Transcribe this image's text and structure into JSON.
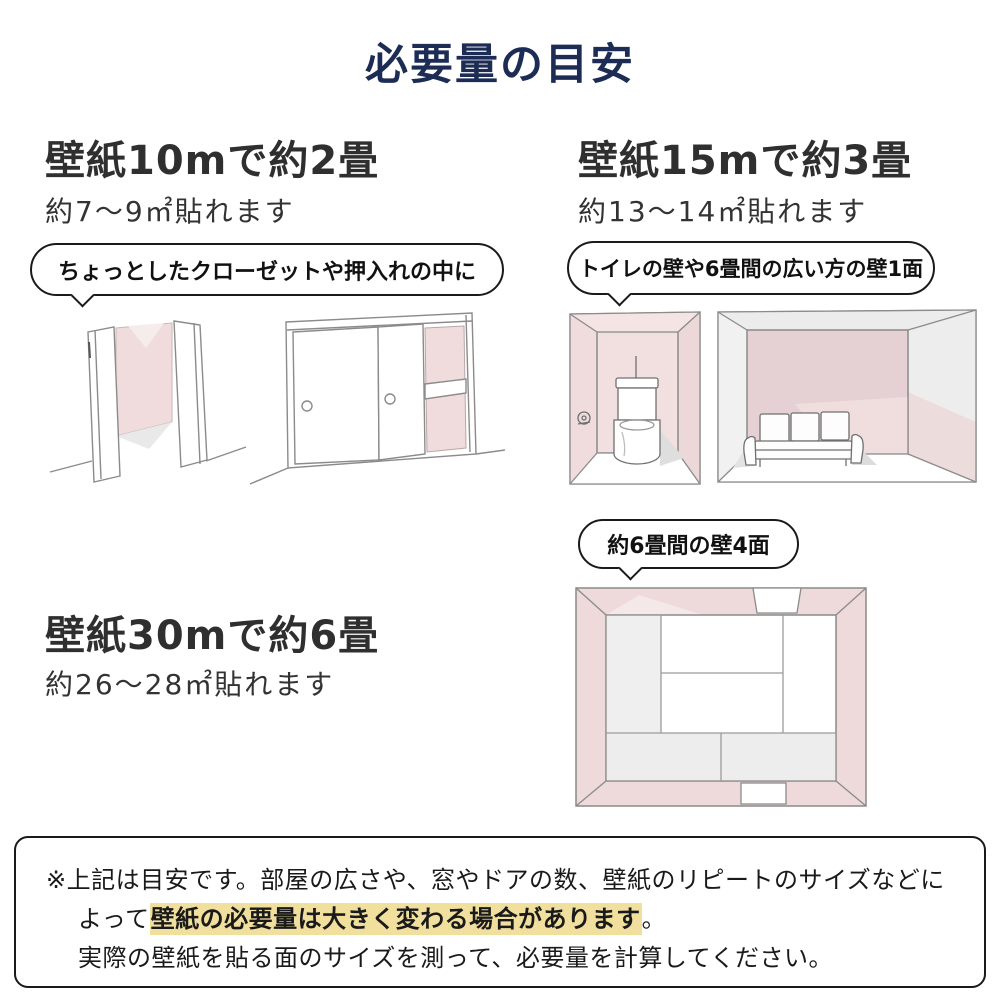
{
  "page": {
    "title": "必要量の目安"
  },
  "sections": [
    {
      "id": "10m",
      "heading": "壁紙10mで約2畳",
      "subtitle": "約7〜9㎡貼れます",
      "bubble": "ちょっとしたクローゼットや押入れの中に",
      "illustrations": [
        "open-closet-sketch",
        "sliding-closet-sketch"
      ]
    },
    {
      "id": "15m",
      "heading": "壁紙15mで約3畳",
      "subtitle": "約13〜14㎡貼れます",
      "bubble": "トイレの壁や6畳間の広い方の壁1面",
      "illustrations": [
        "toilet-room-sketch",
        "living-room-sketch"
      ]
    },
    {
      "id": "30m",
      "heading": "壁紙30mで約6畳",
      "subtitle": "約26〜28㎡貼れます",
      "bubble": "約6畳間の壁4面",
      "illustrations": [
        "tatami-room-top-sketch"
      ]
    }
  ],
  "note": {
    "line1": "※上記は目安です。部屋の広さや、窓やドアの数、壁紙のリピートのサイズなどに",
    "line2_before": "よって",
    "line2_highlight": "壁紙の必要量は大きく変わる場合があります",
    "line2_after": "。",
    "line3": "実際の壁紙を貼る面のサイズを測って、必要量を計算してください。"
  },
  "colors": {
    "title_navy": "#1c2c54",
    "wall_pink": "#f0dcdd",
    "wall_pink_dark": "#e5d1d3",
    "shadow_gray": "#ededed",
    "highlight_yellow": "#f1df9e"
  }
}
